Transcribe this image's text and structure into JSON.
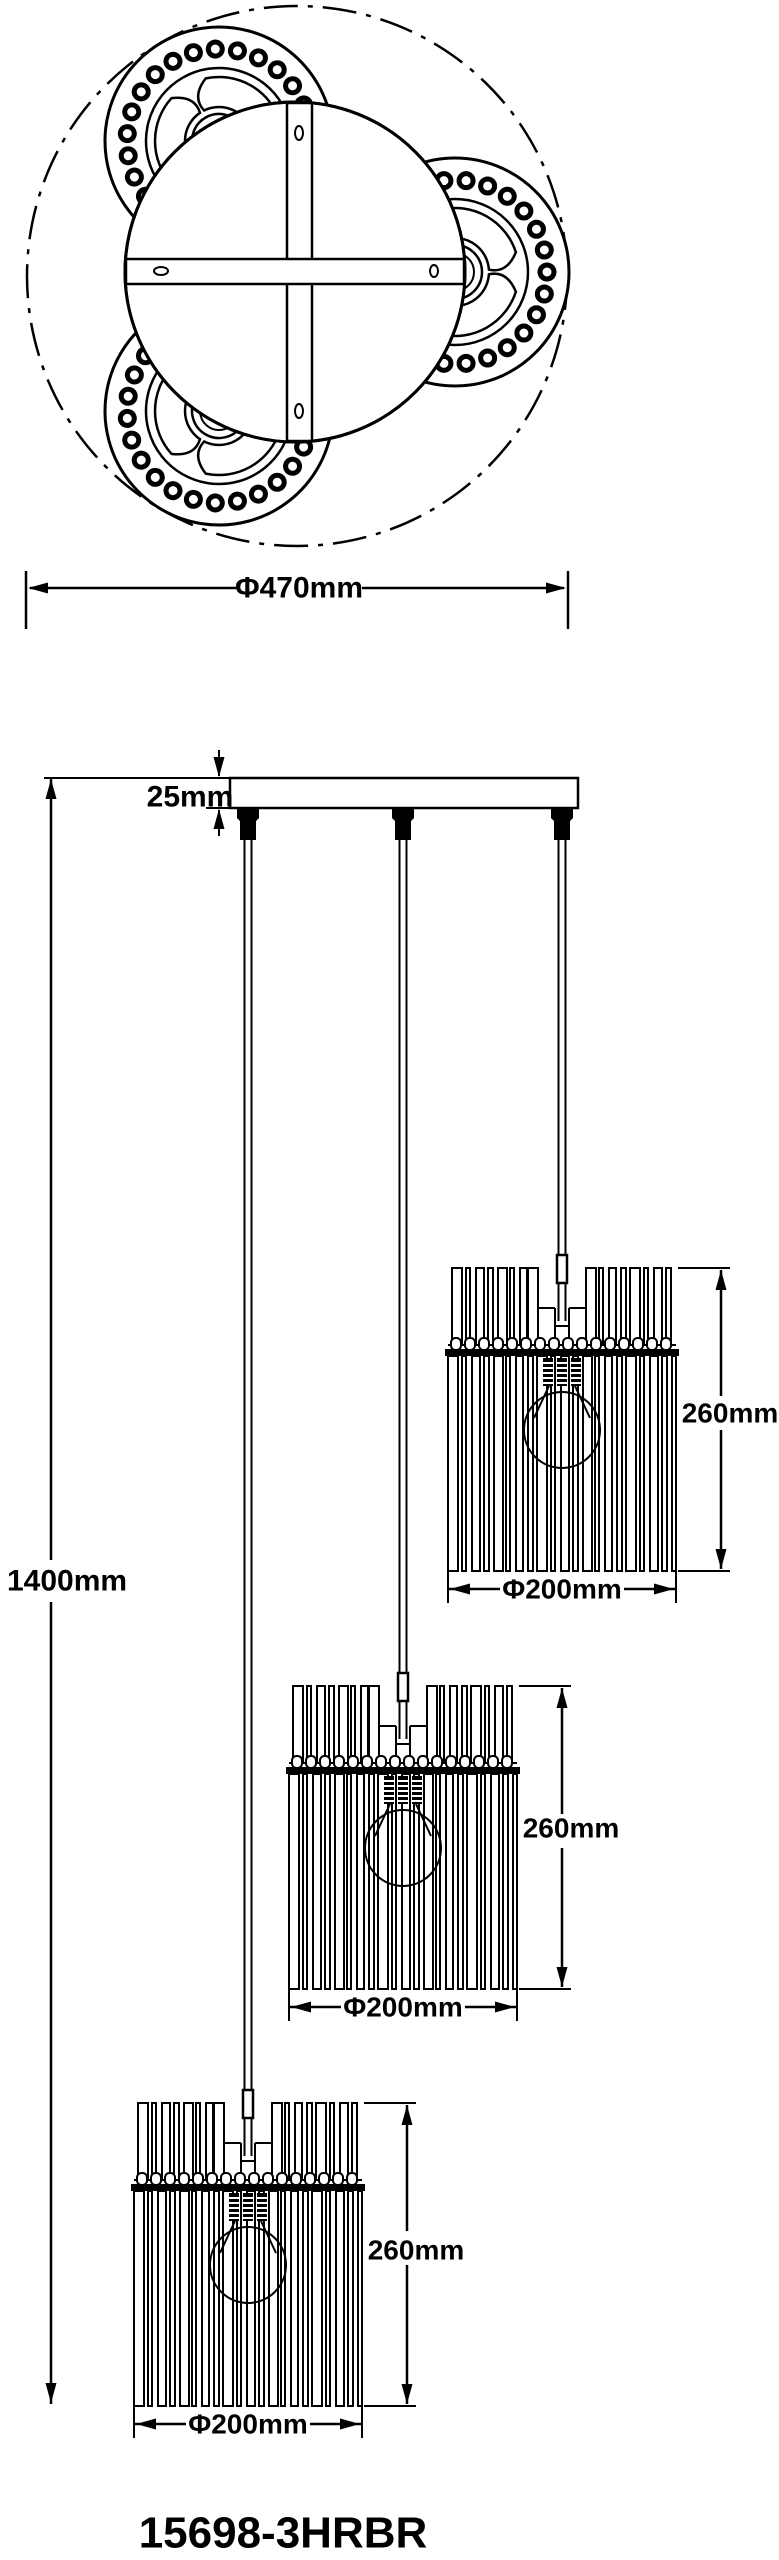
{
  "top_view": {
    "diameter_label": "Φ470mm"
  },
  "front_view": {
    "canopy_thickness_label": "25mm",
    "total_height_label": "1400mm",
    "shades": [
      {
        "height_label": "260mm",
        "diameter_label": "Φ200mm"
      },
      {
        "height_label": "260mm",
        "diameter_label": "Φ200mm"
      },
      {
        "height_label": "260mm",
        "diameter_label": "Φ200mm"
      }
    ]
  },
  "model_number": "15698-3HRBR",
  "colors": {
    "line": "#000000",
    "background": "#ffffff"
  }
}
